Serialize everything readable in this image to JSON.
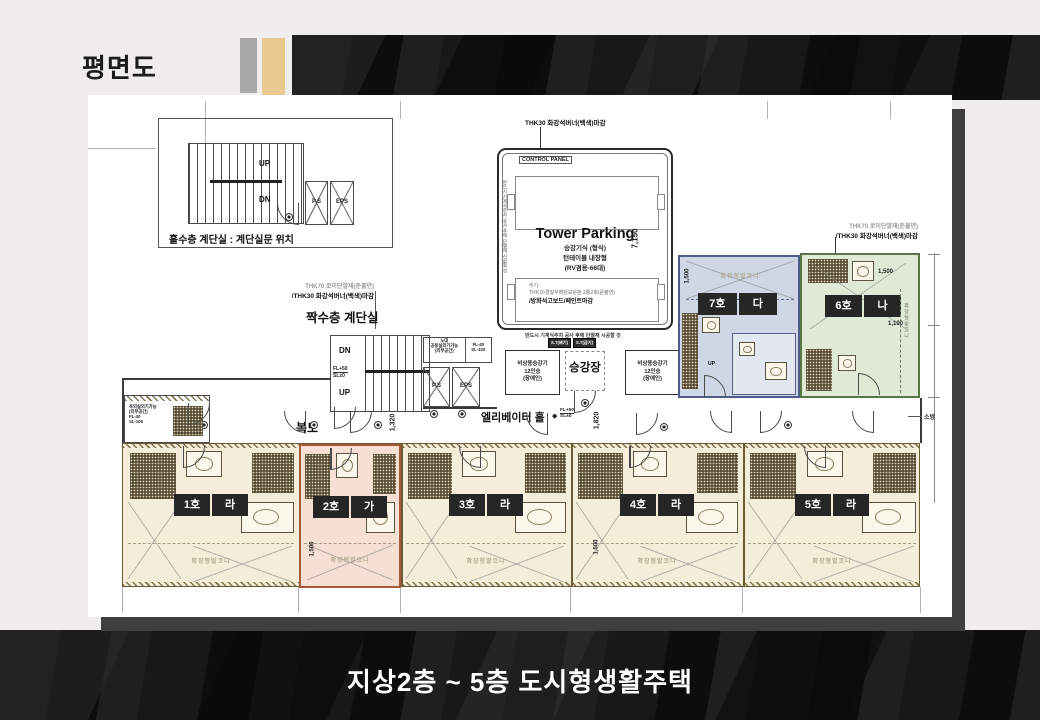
{
  "header": {
    "title": "평면도"
  },
  "footer": {
    "title": "지상2층 ~ 5층 도시형생활주택"
  },
  "colors": {
    "accent_gray": "#a9a9a9",
    "accent_tan": "#e8c98e",
    "unit_cream": "#f3edd9",
    "unit_pink": "#f6e0d3",
    "unit_blue": "#cfd7e6",
    "unit_green": "#e0e9d6",
    "badge_bg": "#262626"
  },
  "plan": {
    "detail": {
      "caption": "홀수층 계단실 : 계단실문 위치",
      "up": "UP",
      "dn": "DN",
      "ps": "P.S",
      "eps": "EPS"
    },
    "finish_note": {
      "line1": "THK70 로이단열재(준불연)",
      "line2": "/THK30 화강석버너(백색)마감"
    },
    "even_stair": {
      "label": "짝수층 계단실",
      "up": "UP",
      "dn": "DN",
      "fl": "FL+50",
      "sl": "SL±0"
    },
    "nodae": {
      "name": "노대",
      "desc1": "공용실외기가능",
      "desc2": "(외부공간)",
      "fl": "FL-40",
      "sl": "SL-100"
    },
    "shafts": {
      "ps": "P.S",
      "eps": "EPS"
    },
    "parking": {
      "top_note": "THK30 화강석버너(백색)마감",
      "control": "CONTROL PANEL",
      "title": "Tower Parking",
      "sub1": "승강기식 (형식)",
      "sub2": "턴테이블 내장형",
      "sub3": "(RV겸용-66대)",
      "dim": "7,150",
      "note_label": "주기:",
      "note1": "THK20경질우레탄보온판 2종2호(준불연)",
      "note2": "/방화석고보드/페인트마감",
      "caution": "반드시 기계식주차 공사 후에 단열재 시공할 것"
    },
    "vents": {
      "left": "S.T(배기)",
      "right": "S.T(급기)"
    },
    "elevator": {
      "l1": "비상용승강기",
      "l2": "12인승",
      "l3": "(장애인)",
      "hall": "승강장",
      "lobby": "엘리베이터 홀",
      "fl": "FL+50",
      "sl": "SL±0"
    },
    "corridor": "복도",
    "fire": "소방",
    "utility": {
      "l1": "옥외실외기가능",
      "l2": "(외부공간)",
      "fl": "FL-40",
      "sl": "SL-100"
    },
    "balcony": "확장형발코니",
    "up": "UP",
    "dims": {
      "d1320": "1,320",
      "d1820": "1,820",
      "d1500": "1,500",
      "d1100": "1,100"
    },
    "units": {
      "u1": {
        "no": "1호",
        "ty": "라"
      },
      "u2": {
        "no": "2호",
        "ty": "가"
      },
      "u3": {
        "no": "3호",
        "ty": "라"
      },
      "u4": {
        "no": "4호",
        "ty": "라"
      },
      "u5": {
        "no": "5호",
        "ty": "라"
      },
      "u6": {
        "no": "6호",
        "ty": "나"
      },
      "u7": {
        "no": "7호",
        "ty": "다"
      }
    }
  }
}
